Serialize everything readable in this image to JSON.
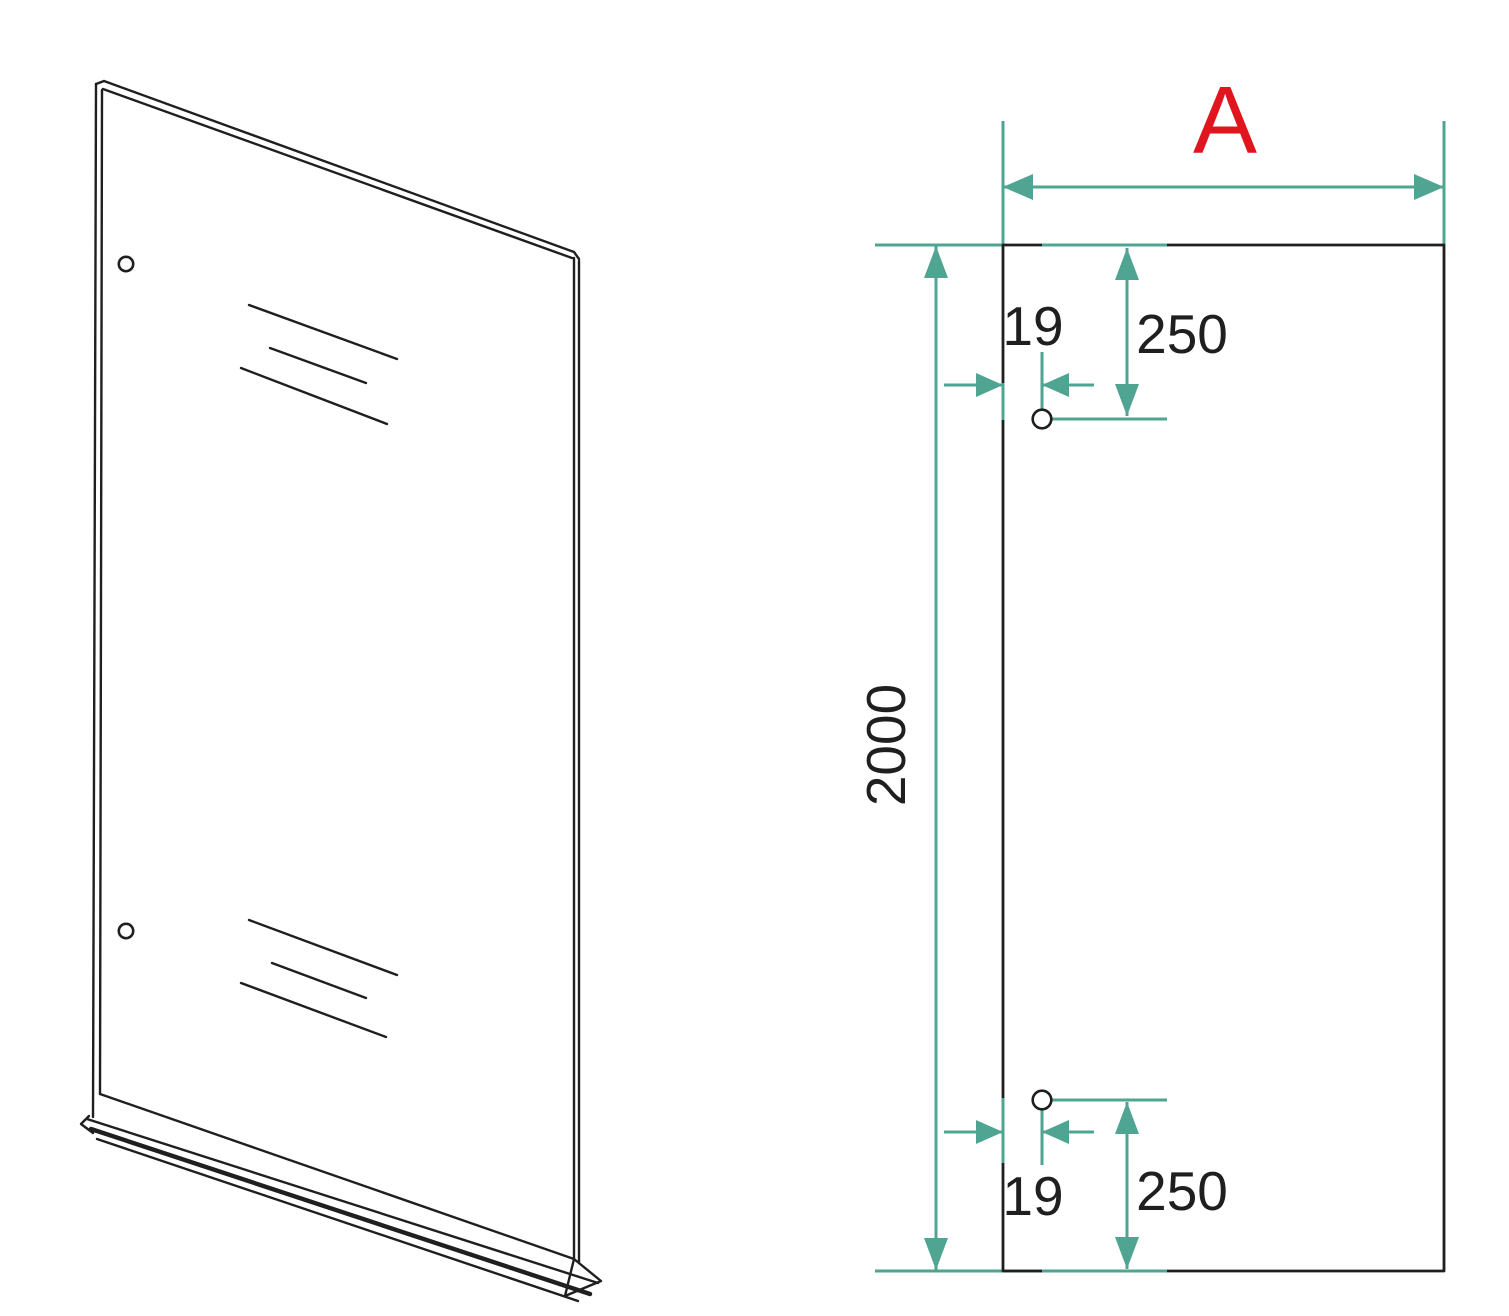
{
  "colors": {
    "bg": "#ffffff",
    "line": "#1f1f1f",
    "dim": "#4fa492",
    "accent": "#e1151d"
  },
  "views": {
    "elevation": {
      "width_label": "A",
      "height_label": "2000",
      "top_hole": {
        "offset_from_edge": "19",
        "offset_from_top": "250"
      },
      "bottom_hole": {
        "offset_from_edge": "19",
        "offset_from_bottom": "250"
      }
    }
  }
}
